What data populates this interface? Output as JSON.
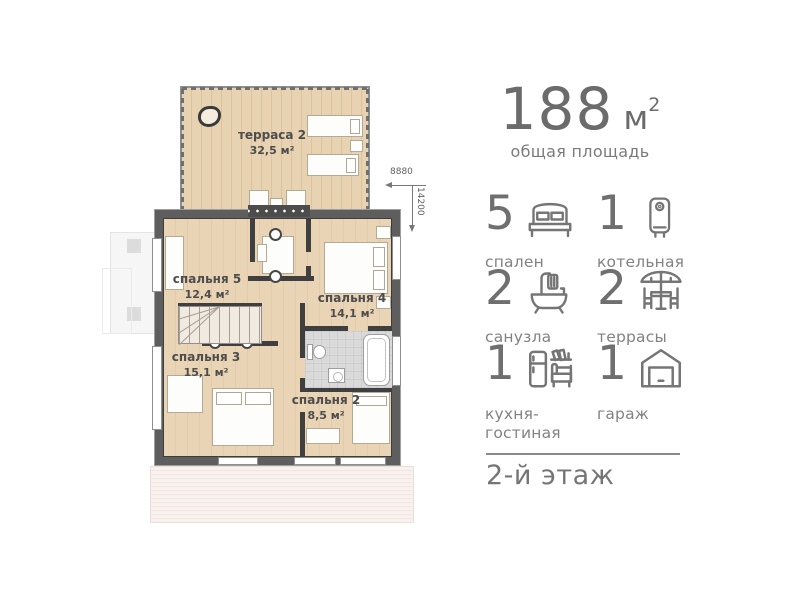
{
  "plan": {
    "rooms": {
      "terrace": {
        "name": "терраса 2",
        "area": "32,5 м²"
      },
      "bedroom5": {
        "name": "спальня 5",
        "area": "12,4 м²"
      },
      "bedroom4": {
        "name": "спальня 4",
        "area": "14,1 м²"
      },
      "bedroom3": {
        "name": "спальня 3",
        "area": "15,1 м²"
      },
      "bedroom2": {
        "name": "спальня 2",
        "area": "8,5 м²"
      }
    },
    "dimensions": {
      "width_mm": "8880",
      "depth_mm": "14200"
    }
  },
  "info": {
    "total_area": {
      "value": "188",
      "unit": "м",
      "sup": "2",
      "label": "общая площадь"
    },
    "features": [
      {
        "count": "5",
        "label": "спален",
        "icon": "bed-icon"
      },
      {
        "count": "1",
        "label": "котельная",
        "icon": "boiler-icon"
      },
      {
        "count": "2",
        "label": "санузла",
        "icon": "bathtub-icon"
      },
      {
        "count": "2",
        "label": "террасы",
        "icon": "terrace-icon"
      },
      {
        "count": "1",
        "label": "кухня-\nгостиная",
        "icon": "kitchen-icon"
      },
      {
        "count": "1",
        "label": "гараж",
        "icon": "garage-icon"
      }
    ],
    "floor": "2-й этаж"
  },
  "colors": {
    "accent_text": "#6b6b6b",
    "label_text": "#828282",
    "wood_floor": "#e9d4b5",
    "terrace_wood": "#e7d2b1",
    "wall": "#5e5e5e",
    "tile": "#dadada"
  }
}
